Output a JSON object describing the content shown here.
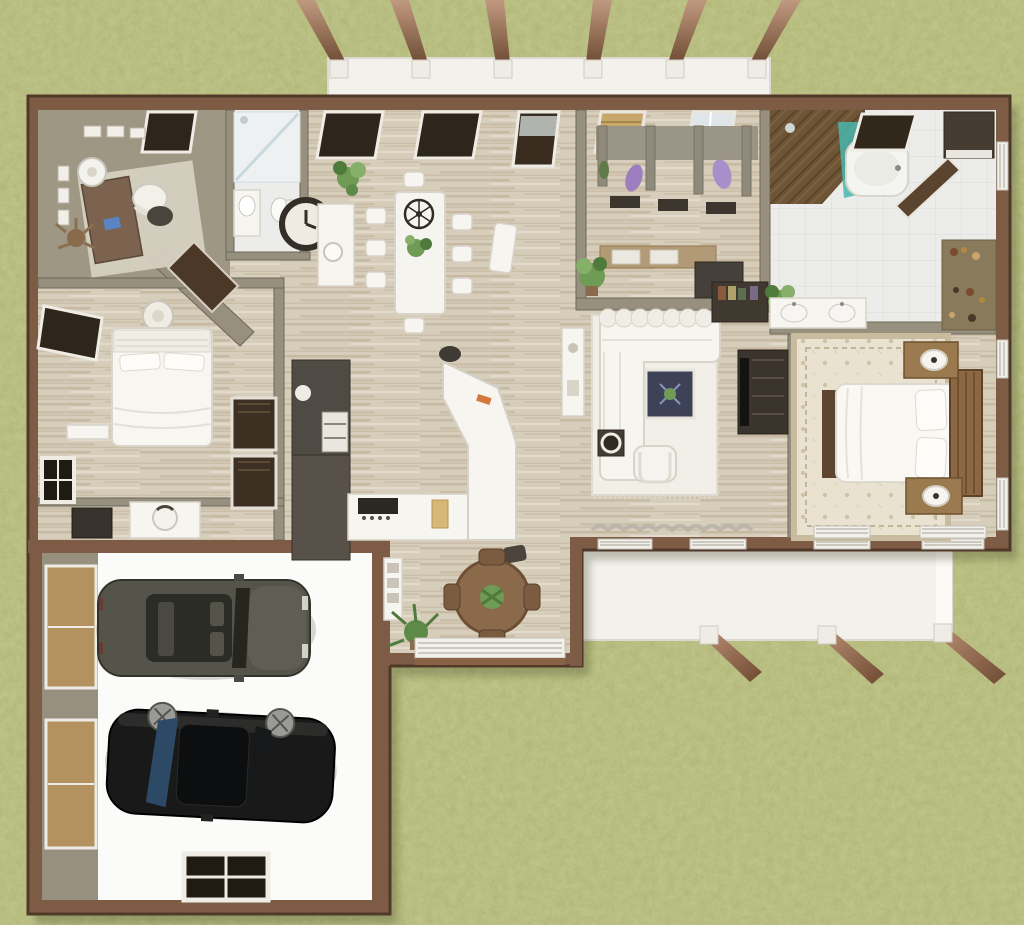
{
  "meta": {
    "description": "Overhead 3D dollhouse rendering of a single-story house floor plan with attached two-car garage, front pergola porch, rear pergola patio and surrounding grass lawn",
    "view": "top-down architectural render",
    "canvas": {
      "width": 1024,
      "height": 925
    }
  },
  "colors": {
    "lawn": "#b8bd7c",
    "lawnShadow": "#3f4426",
    "wallOuter": "#7d5b45",
    "wallEdge": "#51392a",
    "wallInner": "#97907e",
    "woodFloor": "#d7cdbb",
    "darkWoodFloor": "#6e5536",
    "tileFloor": "#ececea",
    "garageFloor": "#fbfbf9",
    "porch": "#f3f1ec",
    "beamLight": "#c09a80",
    "beamDark": "#6f4c34",
    "furnitureWhite": "#f7f5f0",
    "furnitureWhiteShade": "#d8d4ca",
    "furnitureDark": "#423c34",
    "furnitureWood": "#9b7a4f",
    "furnitureWoodDark": "#6e522f",
    "officeOlive": "#9d9783",
    "carGraphite": "#55544b",
    "carBlack": "#191919",
    "windowGlassDark": "#2f261b",
    "showerGlassTeal": "#49b6ac",
    "accentBlue": "#2f86c8",
    "coatPurple": "#9d7fc0",
    "plantGreen": "#6f9b55",
    "plantDark": "#4e7a3c",
    "rugCream": "#eae2d0",
    "rugBorder": "#c9bb9e",
    "coffeeTableNavy": "#3e4258",
    "islandLogoOrange": "#d06a2c",
    "curtainGray": "#b7b3a8",
    "rattanShade": "#c7a76b"
  },
  "scene": {
    "lawn": {
      "name": "grass lawn",
      "texture": "mottled olive green"
    },
    "front_porch": {
      "name": "front porch with pergola",
      "beam_count": 6
    },
    "back_patio": {
      "name": "rear covered patio with pergola",
      "beam_count": 3
    },
    "vehicles": [
      {
        "type": "SUV",
        "color_name": "graphite",
        "position": "garage upper bay"
      },
      {
        "type": "sedan",
        "color_name": "black",
        "position": "garage lower bay"
      }
    ],
    "rooms": [
      {
        "id": "home-office",
        "name": "Home office",
        "furniture": [
          "writing desk",
          "office chair",
          "drum lamp",
          "wall art frames",
          "potted plant",
          "area rug",
          "dark front window"
        ]
      },
      {
        "id": "bathroom",
        "name": "Hall bathroom",
        "furniture": [
          "walk-in shower",
          "vanity",
          "toilet"
        ]
      },
      {
        "id": "bedroom",
        "name": "Bedroom",
        "furniture": [
          "double bed with white duvet",
          "ceiling light",
          "wall shelf",
          "double closet doors",
          "two dark windows"
        ]
      },
      {
        "id": "dressing-area",
        "name": "Dressing nook",
        "furniture": [
          "vanity desk",
          "chair",
          "dark dresser",
          "side window"
        ]
      },
      {
        "id": "garage",
        "name": "Two-car garage",
        "furniture": [
          "graphite SUV",
          "black sedan",
          "rear window",
          "two side windows"
        ]
      },
      {
        "id": "dining-room",
        "name": "Dining room",
        "furniture": [
          "8-seat dining table",
          "wire chandelier",
          "wall clock",
          "console with vase",
          "corner plant",
          "two dark front windows",
          "front door"
        ]
      },
      {
        "id": "kitchen",
        "name": "Kitchen",
        "furniture": [
          "tall cabinet wall with oven",
          "angled island with orange logo",
          "cooktop counter",
          "bar stool"
        ]
      },
      {
        "id": "breakfast-nook",
        "name": "Breakfast nook",
        "furniture": [
          "round wood table",
          "four chairs",
          "potted plant",
          "wide blind window",
          "display shelf"
        ]
      },
      {
        "id": "mudroom",
        "name": "Mudroom hall",
        "furniture": [
          "cubby bench with hooks",
          "hanging coats",
          "rattan-shade window",
          "grid window",
          "built-in desk",
          "potted plant"
        ]
      },
      {
        "id": "living-room",
        "name": "Living room",
        "furniture": [
          "white L-sectional sofa",
          "fringed area rug",
          "navy coffee table",
          "armchair",
          "lamp end table",
          "media console",
          "bookshelf",
          "curtained rear windows"
        ]
      },
      {
        "id": "master-bathroom",
        "name": "Primary bathroom",
        "furniture": [
          "wood-floor shower with teal glass",
          "bathtub",
          "double sink vanity",
          "diagonal barn door",
          "toiletry cabinet",
          "dark corner wardrobe"
        ]
      },
      {
        "id": "master-bedroom",
        "name": "Primary bedroom",
        "furniture": [
          "bed with wood headboard",
          "two wood nightstands with lamps",
          "patterned cream rug",
          "foot bench",
          "blind windows"
        ]
      }
    ]
  }
}
